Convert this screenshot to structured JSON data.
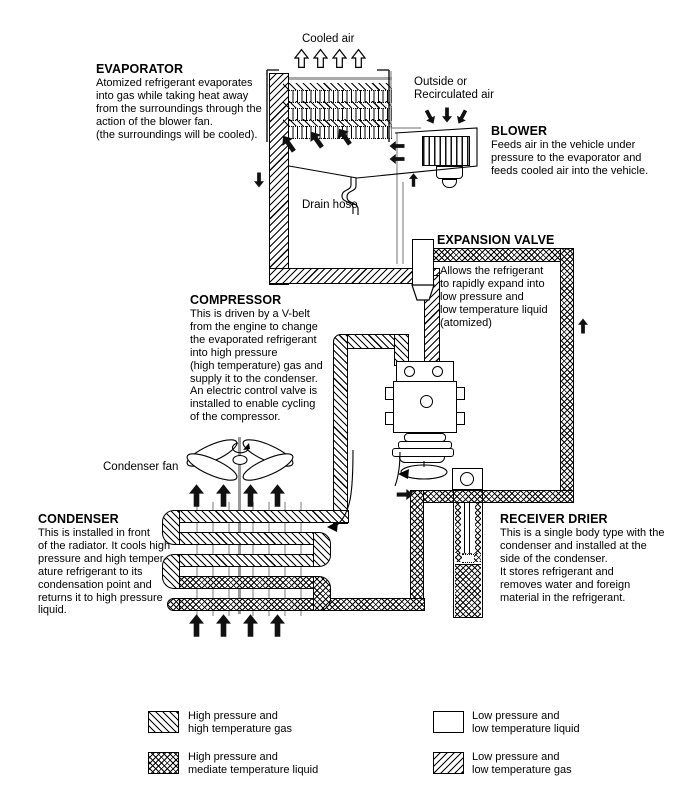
{
  "colors": {
    "ink": "#000000",
    "background": "#ffffff"
  },
  "labels": {
    "cooled_air": "Cooled air",
    "outside_air": "Outside or\nRecirculated air",
    "drain_hose": "Drain hose",
    "condenser_fan": "Condenser fan"
  },
  "components": {
    "evaporator": {
      "title": "EVAPORATOR",
      "desc": "Atomized refrigerant evaporates\ninto gas while taking heat away\nfrom the surroundings through the\naction of the blower fan.\n(the surroundings will be cooled)."
    },
    "blower": {
      "title": "BLOWER",
      "desc": "Feeds air in the vehicle under\npressure to the evaporator and\nfeeds cooled air into the vehicle."
    },
    "expansion_valve": {
      "title": "EXPANSION VALVE",
      "desc": "Allows the refrigerant\nto rapidly expand into\nlow pressure and\nlow temperature liquid\n(atomized)"
    },
    "compressor": {
      "title": "COMPRESSOR",
      "desc": "This is driven by a V-belt\nfrom the engine to change\nthe evaporated refrigerant\ninto high pressure\n(high temperature) gas and\nsupply it to the condenser.\nAn electric control valve is\ninstalled to enable cycling\nof the compressor."
    },
    "condenser": {
      "title": "CONDENSER",
      "desc": "This is installed in front\nof the radiator. It cools high\npressure and high temper-\nature refrigerant to its\ncondensation point and\nreturns it to high pressure\nliquid."
    },
    "receiver_drier": {
      "title": "RECEIVER DRIER",
      "desc": "This is a single body type with the\ncondenser and installed at the\nside of the condenser.\nIt stores refrigerant and\nremoves water and foreign\nmaterial in the refrigerant."
    }
  },
  "legend": {
    "items": [
      {
        "name": "high-pressure-high-temperature-gas",
        "pattern": "diagonal-backslash-hatch",
        "label": "High pressure and\nhigh temperature gas"
      },
      {
        "name": "high-pressure-mediate-temperature-liquid",
        "pattern": "cross-hatch",
        "label": "High pressure and\nmediate temperature liquid"
      },
      {
        "name": "low-pressure-low-temperature-liquid",
        "pattern": "plain-white",
        "label": "Low pressure and\nlow temperature liquid"
      },
      {
        "name": "low-pressure-low-temperature-gas",
        "pattern": "diagonal-slash-hatch",
        "label": "Low pressure and\nlow temperature gas"
      }
    ]
  }
}
